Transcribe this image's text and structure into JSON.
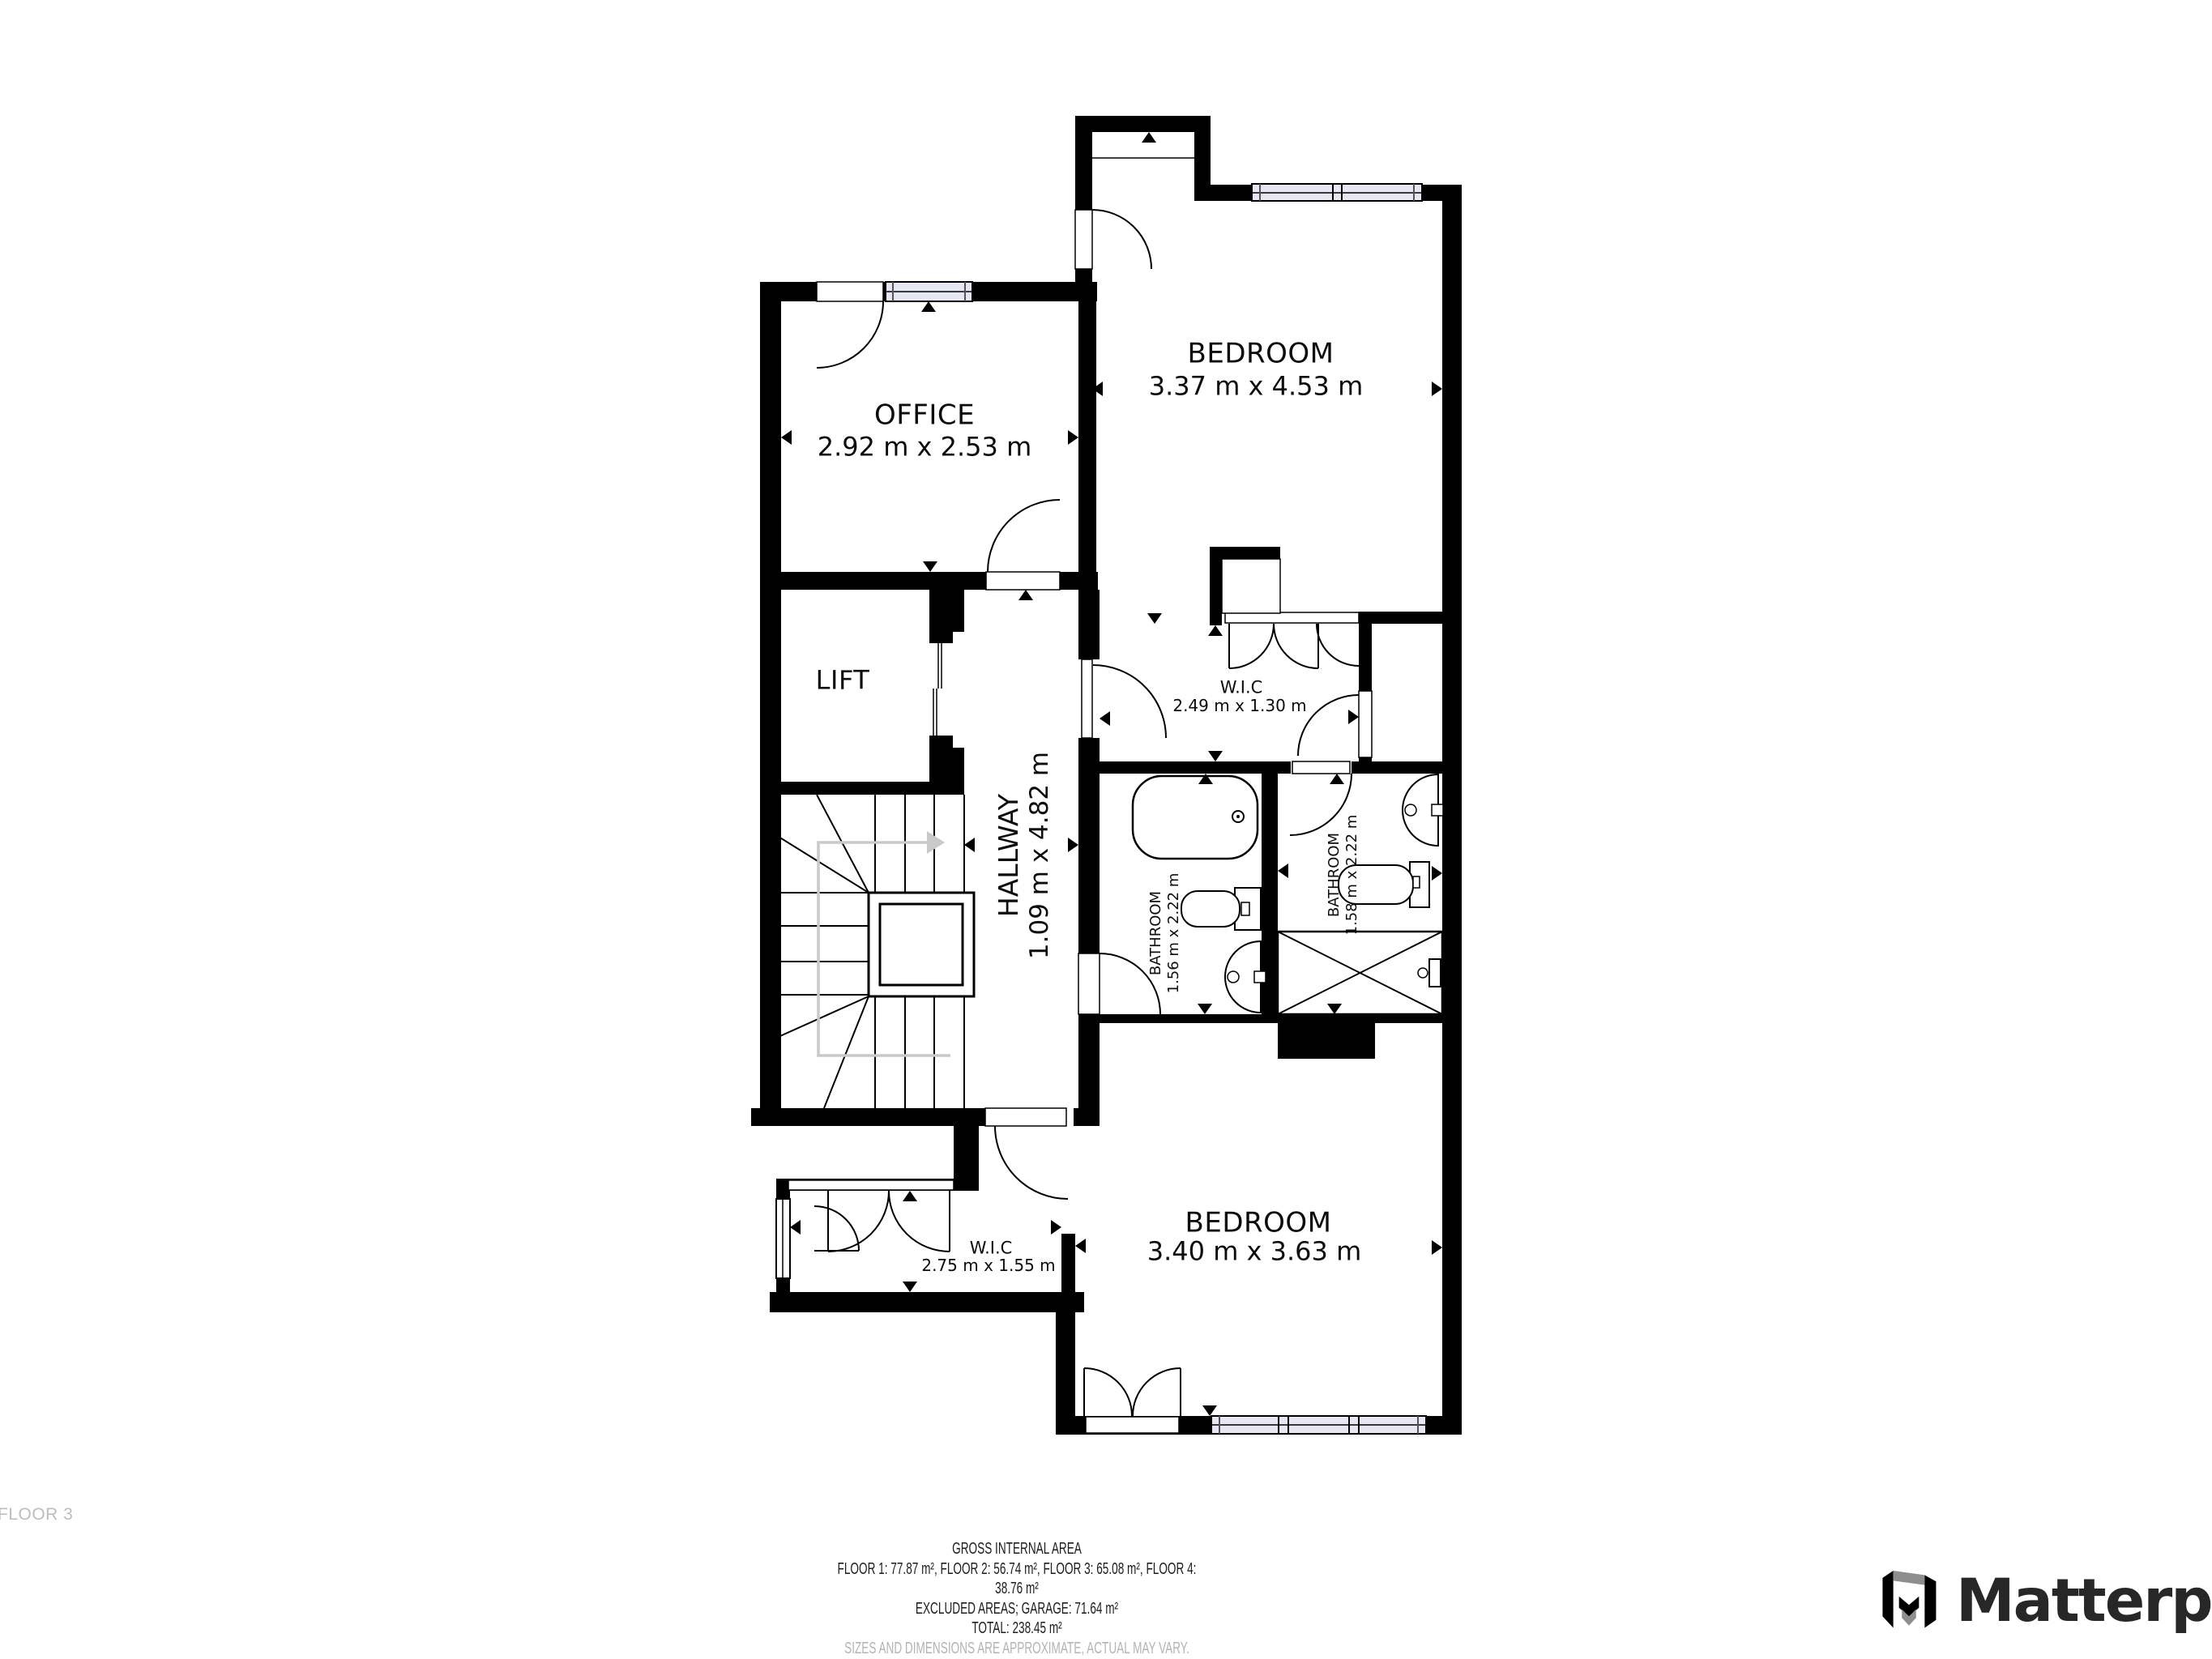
{
  "floor_label": "FLOOR 3",
  "rooms": {
    "office": {
      "name": "OFFICE",
      "dims": "2.92 m x 2.53 m"
    },
    "bedroom_top": {
      "name": "BEDROOM",
      "dims": "3.37 m x 4.53 m"
    },
    "lift": {
      "name": "LIFT"
    },
    "hallway": {
      "name": "HALLWAY",
      "dims": "1.09 m x 4.82 m"
    },
    "wic_top": {
      "name": "W.I.C",
      "dims": "2.49 m x 1.30 m"
    },
    "bathroom_left": {
      "name": "BATHROOM",
      "dims": "1.56 m x 2.22 m"
    },
    "bathroom_right": {
      "name": "BATHROOM",
      "dims": "1.58 m x 2.22 m"
    },
    "wic_bottom": {
      "name": "W.I.C",
      "dims": "2.75 m x 1.55 m"
    },
    "bedroom_bottom": {
      "name": "BEDROOM",
      "dims": "3.40 m x 3.63 m"
    }
  },
  "footer": {
    "title": "GROSS INTERNAL AREA",
    "floors": "FLOOR 1: 77.87 m², FLOOR 2: 56.74 m², FLOOR 3: 65.08 m², FLOOR 4: 38.76 m²",
    "excluded": "EXCLUDED AREAS; GARAGE: 71.64 m²",
    "total": "TOTAL: 238.45 m²",
    "disclaimer": "SIZES AND DIMENSIONS ARE APPROXIMATE, ACTUAL MAY VARY."
  },
  "brand": {
    "name": "Matterport"
  },
  "colors": {
    "wall": "#000000",
    "window_fill": "#e6e7f3",
    "stair_guide": "#c9c9c9",
    "muted_text": "#b4b4b4",
    "footer_text": "#1d1d1d",
    "brand_text": "#272727",
    "logo_gray": "#8e8e8e"
  }
}
